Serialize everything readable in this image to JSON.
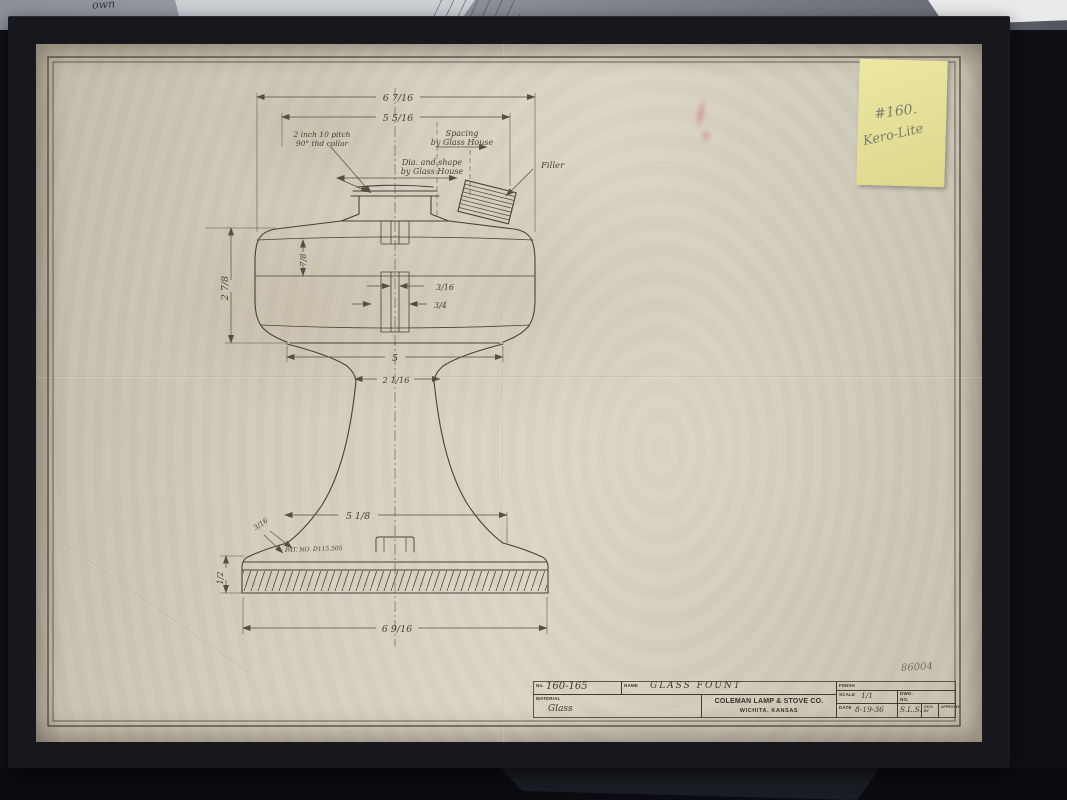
{
  "scene": {
    "backdrop_note": "own"
  },
  "sticky_note": {
    "line1": "#160.",
    "line2": "Kero-Lite"
  },
  "drawing": {
    "dims": {
      "top_width": "6 7/16",
      "collar_span": "5 5/16",
      "bowl_height": "2 7/8",
      "upper_seam": "7/8",
      "band_small": "3/16",
      "band_large": "3/4",
      "bowl_bottom": "5",
      "waist": "2 1/16",
      "pedestal_width": "5 1/8",
      "base_lip": "3/16",
      "base_height": "1/2",
      "base_width": "6 9/16"
    },
    "callouts": {
      "collar_l1": "2 inch 10 pitch",
      "collar_l2": "90° thd collar",
      "spacing_l1": "Spacing",
      "spacing_l2": "by Glass House",
      "dia_l1": "Dia. and shape",
      "dia_l2": "by Glass House",
      "filler": "Filler",
      "patent": "PAT. NO. D115,505"
    }
  },
  "title_block": {
    "no_label": "No.",
    "no_value": "160-165",
    "name_label": "NAME",
    "name_value": "GLASS FOUNT",
    "material_label": "MATERIAL",
    "material_value": "Glass",
    "company_line1": "COLEMAN LAMP & STOVE CO.",
    "company_line2": "WICHITA, KANSAS",
    "finish_label": "FINISH",
    "scale_label": "SCALE",
    "scale_value": "1/1",
    "dwg_label": "DWG.",
    "dwg_label2": "NO.",
    "date_label": "DATE",
    "date_value": "8-19-36",
    "drafter_initials": "S.L.S.",
    "ckd_label": "CK'D BY",
    "approved_label": "APPROVED",
    "sheet_note": "86004"
  }
}
